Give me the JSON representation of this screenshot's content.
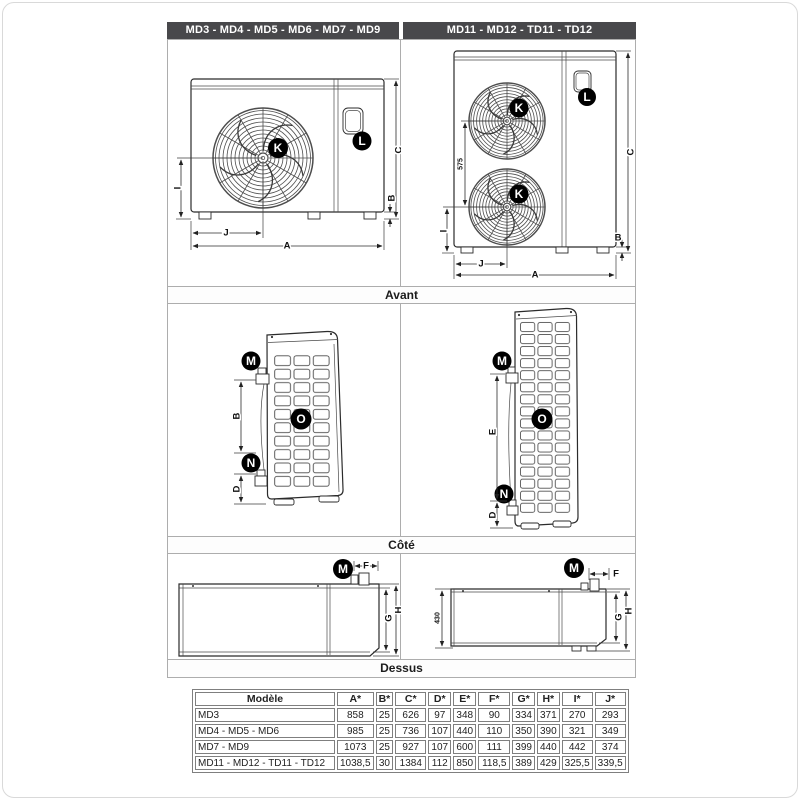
{
  "headers": {
    "left": "MD3 - MD4 - MD5 - MD6 - MD7 - MD9",
    "right": "MD11 - MD12 - TD11 - TD12"
  },
  "sections": {
    "front": "Avant",
    "side": "Côté",
    "top": "Dessus"
  },
  "labels": {
    "A": "A",
    "B": "B",
    "C": "C",
    "D": "D",
    "E": "E",
    "F": "F",
    "G": "G",
    "H": "H",
    "I": "I",
    "J": "J",
    "K": "K",
    "L": "L",
    "M": "M",
    "N": "N",
    "O": "O",
    "dim575": "575",
    "dim430": "430"
  },
  "table": {
    "columns": [
      "Modèle",
      "A*",
      "B*",
      "C*",
      "D*",
      "E*",
      "F*",
      "G*",
      "H*",
      "I*",
      "J*"
    ],
    "rows": [
      {
        "model": "MD3",
        "values": [
          "858",
          "25",
          "626",
          "97",
          "348",
          "90",
          "334",
          "371",
          "270",
          "293"
        ]
      },
      {
        "model": "MD4 - MD5 - MD6",
        "values": [
          "985",
          "25",
          "736",
          "107",
          "440",
          "110",
          "350",
          "390",
          "321",
          "349"
        ]
      },
      {
        "model": "MD7 - MD9",
        "values": [
          "1073",
          "25",
          "927",
          "107",
          "600",
          "111",
          "399",
          "440",
          "442",
          "374"
        ]
      },
      {
        "model": "MD11 - MD12 - TD11 - TD12",
        "values": [
          "1038,5",
          "30",
          "1384",
          "112",
          "850",
          "118,5",
          "389",
          "429",
          "325,5",
          "339,5"
        ]
      }
    ]
  },
  "colors": {
    "header_bg": "#48484b",
    "panel_border": "#adadad",
    "table_border": "#7f7f7f",
    "ink": "#2b2b2b"
  }
}
